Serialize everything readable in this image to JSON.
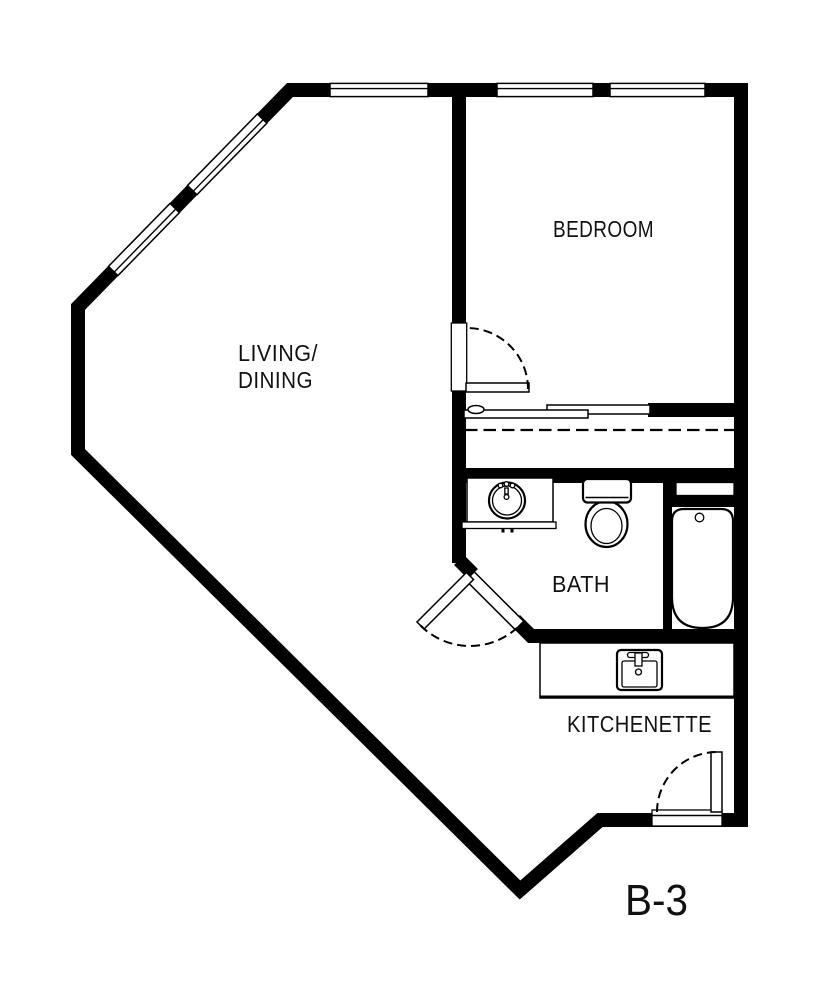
{
  "unit_label": "B-3",
  "rooms": {
    "living_dining": {
      "line1": "LIVING/",
      "line2": "DINING"
    },
    "bedroom": {
      "label": "BEDROOM"
    },
    "bath": {
      "label": "BATH"
    },
    "kitchenette": {
      "label": "KITCHENETTE"
    }
  },
  "fixtures": {
    "bath_vanity_sink": "round-basin-vanity-sink",
    "toilet": "toilet-with-tank",
    "bathtub": "alcove-bathtub",
    "kitchen_sink": "single-bowl-kitchen-sink-with-faucet"
  },
  "doors": {
    "bedroom_door": "hinged-door-with-swing-arc",
    "bath_door": "diagonal-hinged-door-with-swing-arc",
    "entry_door": "hinged-entry-door-with-swing-arc",
    "closet_doors": "bypass-sliding-doors-with-dashed-shelf-line"
  },
  "windows": [
    "top-wall-window-1",
    "top-wall-window-2",
    "top-wall-window-3",
    "diagonal-wall-window-1",
    "diagonal-wall-window-2"
  ],
  "colors": {
    "wall": "#000000",
    "background": "#ffffff",
    "text": "#111111"
  }
}
